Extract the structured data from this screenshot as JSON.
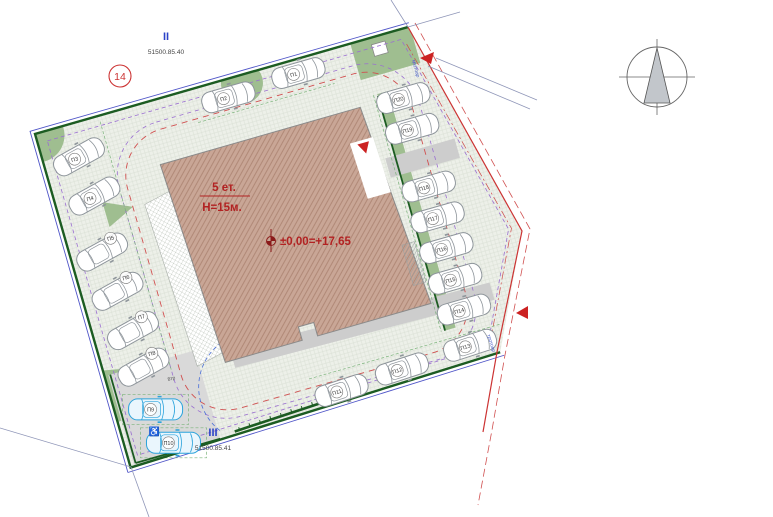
{
  "drawing": {
    "type": "site-plan",
    "plot_number": "14",
    "parcels": {
      "top": {
        "roman": "II",
        "cadastral": "51500.85.40"
      },
      "bottom": {
        "roman": "III",
        "cadastral": "51500.85.41"
      }
    },
    "building": {
      "floors_label": "5 ет.",
      "height_label": "Н=15м.",
      "level_label": "±0,00=+17,65"
    },
    "annotations": {
      "sidewalk_top": "тротоар",
      "sidewalk_right": "тротоар",
      "curb": "8тр",
      "accessible_symbol": "♿"
    }
  },
  "parking": {
    "spots": [
      {
        "label": "П1"
      },
      {
        "label": "П2"
      },
      {
        "label": "П3"
      },
      {
        "label": "П4"
      },
      {
        "label": "П5"
      },
      {
        "label": "П6"
      },
      {
        "label": "П7"
      },
      {
        "label": "П8"
      },
      {
        "label": "П9",
        "accessible": true
      },
      {
        "label": "П10",
        "accessible": true
      },
      {
        "label": "П11"
      },
      {
        "label": "П12"
      },
      {
        "label": "П13"
      },
      {
        "label": "П14"
      },
      {
        "label": "П15"
      },
      {
        "label": "П16"
      },
      {
        "label": "П17"
      },
      {
        "label": "П18"
      },
      {
        "label": "П19"
      },
      {
        "label": "П20"
      }
    ]
  },
  "colors": {
    "building_fill": "#c9a696",
    "building_hatch": "#ad8573",
    "lawn_green": "#9fbe90",
    "boundary_green": "#1c5c22",
    "cadastral_red": "#cc3333",
    "setback_purple": "#9a6fd0",
    "accessible_blue": "#2ba3dc",
    "label_blue": "#2b43c8",
    "paving": "#edf0e9",
    "walkway_gray": "#cdcdcd"
  }
}
